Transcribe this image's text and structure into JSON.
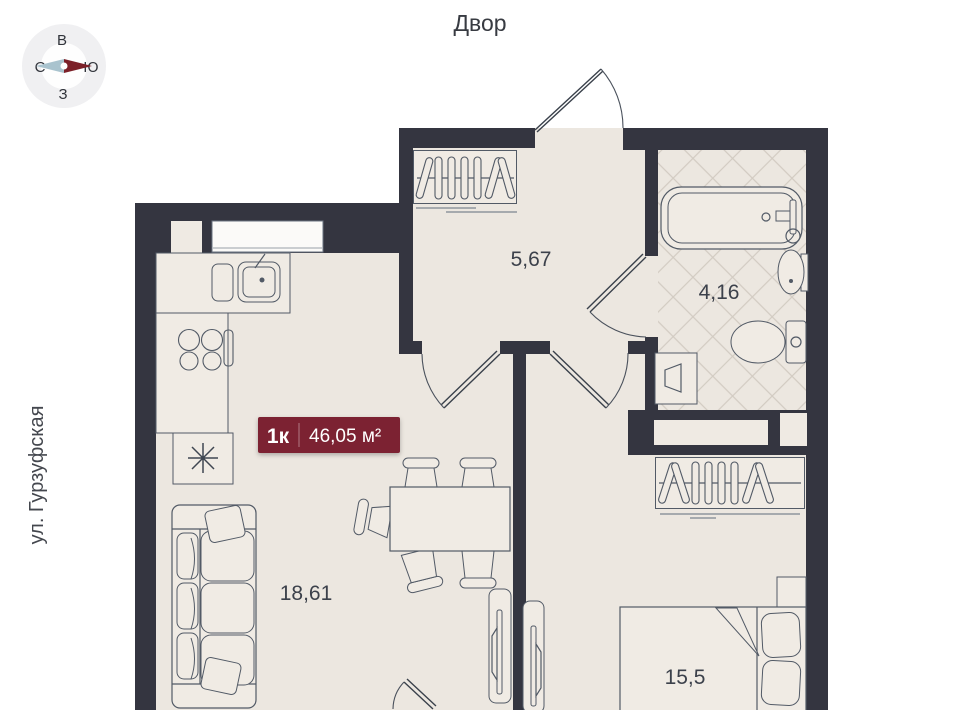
{
  "labels": {
    "courtyard": "Двор",
    "street": "ул. Гурзуфская"
  },
  "compass": {
    "top": "В",
    "left": "С",
    "right": "Ю",
    "bottom": "З"
  },
  "badge": {
    "rooms": "1к",
    "area": "46,05 м²"
  },
  "rooms": {
    "hall": "5,67",
    "bathroom": "4,16",
    "living_kitchen": "18,61",
    "bedroom": "15,5"
  },
  "colors": {
    "wall": "#343540",
    "floor": "#ece7e0",
    "hatch": "#d2cbc2",
    "badge_bg": "#7b2431",
    "needle_left": "#a9c3ce",
    "needle_right": "#7c2028",
    "compass_ring": "#f0f0f2"
  }
}
